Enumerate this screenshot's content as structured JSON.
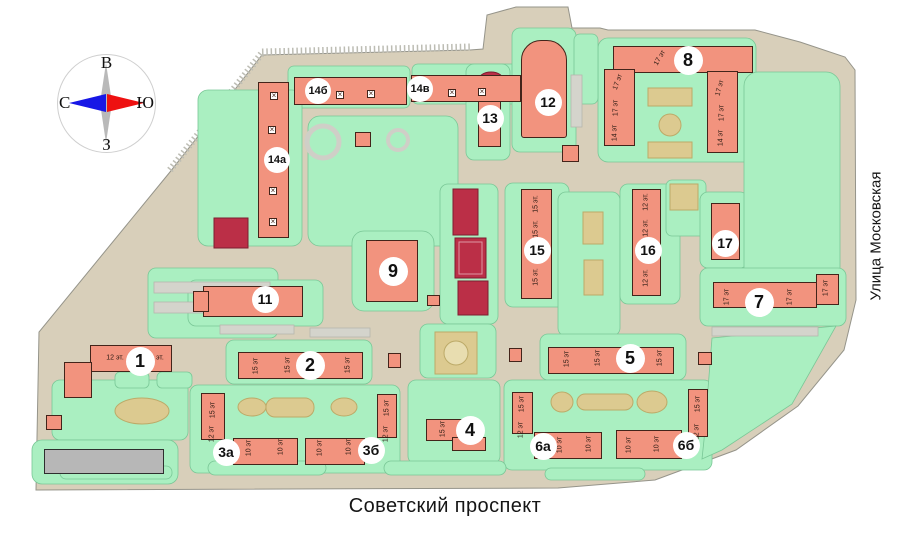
{
  "title": "Генплан жилого комплекса",
  "compass": {
    "top": "В",
    "bottom": "З",
    "left": "С",
    "right": "Ю"
  },
  "streets": {
    "bottom": "Советский проспект",
    "right": "Улица Московская"
  },
  "colors": {
    "building": "#f2937e",
    "building-border": "#43241a",
    "lawn": "#aaefc1",
    "lawn-border": "#79c796",
    "road": "#d8cfba",
    "road-border": "#95948a",
    "court": "#bb2f47",
    "court-border": "#7e1e30",
    "tan": "#dcca90",
    "tan-border": "#bcaa68",
    "gray-building": "#b7b7b7",
    "gray-building-border": "#2e2e2e",
    "parking": "#d4d4cc",
    "parking-border": "#b6b6ad",
    "compass-north": "#1717e6",
    "compass-south": "#ee1111",
    "page-bg": "#ffffff"
  },
  "buildings": [
    {
      "number": "1",
      "cx": 140,
      "cy": 361,
      "parts": [
        {
          "x": 90,
          "y": 345,
          "w": 82,
          "h": 27
        },
        {
          "x": 64,
          "y": 362,
          "w": 28,
          "h": 36
        }
      ],
      "floors": [
        {
          "t": "12 эт.",
          "x": 115,
          "y": 358,
          "r": 0
        },
        {
          "t": "12 эт.",
          "x": 155,
          "y": 358,
          "r": 0
        }
      ]
    },
    {
      "number": "2",
      "cx": 310,
      "cy": 365,
      "parts": [
        {
          "x": 238,
          "y": 352,
          "w": 125,
          "h": 27
        }
      ],
      "floors": [
        {
          "t": "15 эт",
          "x": 256,
          "y": 366
        },
        {
          "t": "15 эт",
          "x": 288,
          "y": 365
        },
        {
          "t": "15 эт",
          "x": 348,
          "y": 365
        }
      ]
    },
    {
      "number": "3а",
      "cx": 226,
      "cy": 452,
      "parts": [
        {
          "x": 201,
          "y": 393,
          "w": 24,
          "h": 47
        },
        {
          "x": 233,
          "y": 438,
          "w": 65,
          "h": 27
        }
      ],
      "floors": [
        {
          "t": "15 эт",
          "x": 213,
          "y": 410
        },
        {
          "t": "12 эт",
          "x": 212,
          "y": 434
        },
        {
          "t": "10 эт",
          "x": 249,
          "y": 448
        },
        {
          "t": "10 эт",
          "x": 281,
          "y": 447
        }
      ]
    },
    {
      "number": "3б",
      "cx": 371,
      "cy": 450,
      "parts": [
        {
          "x": 305,
          "y": 438,
          "w": 60,
          "h": 27
        },
        {
          "x": 377,
          "y": 394,
          "w": 20,
          "h": 44
        }
      ],
      "floors": [
        {
          "t": "10 эт",
          "x": 320,
          "y": 448
        },
        {
          "t": "10 эт",
          "x": 349,
          "y": 447
        },
        {
          "t": "15 эт",
          "x": 387,
          "y": 408
        },
        {
          "t": "12 эт",
          "x": 386,
          "y": 434
        }
      ]
    },
    {
      "number": "4",
      "cx": 470,
      "cy": 430,
      "parts": [
        {
          "x": 426,
          "y": 419,
          "w": 50,
          "h": 22
        },
        {
          "x": 452,
          "y": 437,
          "w": 34,
          "h": 14
        }
      ],
      "floors": [
        {
          "t": "15 эт",
          "x": 443,
          "y": 429
        }
      ]
    },
    {
      "number": "5",
      "cx": 630,
      "cy": 358,
      "parts": [
        {
          "x": 548,
          "y": 347,
          "w": 126,
          "h": 27
        }
      ],
      "floors": [
        {
          "t": "15 эт",
          "x": 567,
          "y": 359
        },
        {
          "t": "15 эт",
          "x": 598,
          "y": 358
        },
        {
          "t": "15 эт",
          "x": 660,
          "y": 358
        }
      ]
    },
    {
      "number": "6а",
      "cx": 543,
      "cy": 446,
      "parts": [
        {
          "x": 512,
          "y": 392,
          "w": 21,
          "h": 42
        },
        {
          "x": 534,
          "y": 432,
          "w": 68,
          "h": 27
        }
      ],
      "floors": [
        {
          "t": "15 эт",
          "x": 522,
          "y": 404
        },
        {
          "t": "12 эт",
          "x": 521,
          "y": 430
        },
        {
          "t": "10 эт",
          "x": 560,
          "y": 445
        },
        {
          "t": "10 эт",
          "x": 589,
          "y": 444
        }
      ]
    },
    {
      "number": "6б",
      "cx": 686,
      "cy": 445,
      "parts": [
        {
          "x": 616,
          "y": 430,
          "w": 66,
          "h": 29
        },
        {
          "x": 688,
          "y": 389,
          "w": 20,
          "h": 48
        }
      ],
      "floors": [
        {
          "t": "10 эт",
          "x": 629,
          "y": 445
        },
        {
          "t": "10 эт",
          "x": 657,
          "y": 444
        },
        {
          "t": "15 эт",
          "x": 698,
          "y": 404
        },
        {
          "t": "12 эт",
          "x": 697,
          "y": 432
        }
      ]
    },
    {
      "number": "7",
      "cx": 759,
      "cy": 302,
      "parts": [
        {
          "x": 713,
          "y": 282,
          "w": 104,
          "h": 26
        },
        {
          "x": 816,
          "y": 274,
          "w": 23,
          "h": 31
        }
      ],
      "floors": [
        {
          "t": "17 эт",
          "x": 727,
          "y": 297
        },
        {
          "t": "17 эт",
          "x": 790,
          "y": 297
        },
        {
          "t": "17 эт",
          "x": 826,
          "y": 288
        }
      ]
    },
    {
      "number": "8",
      "cx": 688,
      "cy": 60,
      "parts": [
        {
          "x": 613,
          "y": 46,
          "w": 140,
          "h": 27
        },
        {
          "x": 604,
          "y": 69,
          "w": 31,
          "h": 77
        },
        {
          "x": 707,
          "y": 71,
          "w": 31,
          "h": 82
        }
      ],
      "floors": [
        {
          "t": "17 эт",
          "x": 660,
          "y": 58,
          "r": -60
        },
        {
          "t": "17 эт",
          "x": 618,
          "y": 82,
          "r": -70
        },
        {
          "t": "17 эт",
          "x": 616,
          "y": 108
        },
        {
          "t": "14 эт",
          "x": 615,
          "y": 133
        },
        {
          "t": "17 эт",
          "x": 720,
          "y": 88,
          "r": -75
        },
        {
          "t": "17 эт",
          "x": 722,
          "y": 113
        },
        {
          "t": "14 эт",
          "x": 721,
          "y": 138
        }
      ]
    },
    {
      "number": "9",
      "cx": 393,
      "cy": 271,
      "parts": [
        {
          "x": 366,
          "y": 240,
          "w": 52,
          "h": 62
        }
      ]
    },
    {
      "number": "11",
      "cx": 265,
      "cy": 299,
      "parts": [
        {
          "x": 203,
          "y": 286,
          "w": 100,
          "h": 31
        },
        {
          "x": 193,
          "y": 291,
          "w": 16,
          "h": 21
        }
      ]
    },
    {
      "number": "12",
      "cx": 548,
      "cy": 102,
      "parts": [
        {
          "x": 521,
          "y": 40,
          "w": 46,
          "h": 98,
          "rad": "20px 20px 3px 3px"
        }
      ]
    },
    {
      "number": "13",
      "cx": 490,
      "cy": 118,
      "parts": [
        {
          "x": 478,
          "y": 97,
          "w": 23,
          "h": 50
        }
      ]
    },
    {
      "number": "14а",
      "cx": 277,
      "cy": 160,
      "parts": [
        {
          "x": 258,
          "y": 82,
          "w": 31,
          "h": 156
        }
      ],
      "marks": [
        {
          "x": 274,
          "y": 96
        },
        {
          "x": 272,
          "y": 130
        },
        {
          "x": 273,
          "y": 191
        },
        {
          "x": 273,
          "y": 222
        }
      ]
    },
    {
      "number": "14б",
      "cx": 318,
      "cy": 91,
      "parts": [
        {
          "x": 294,
          "y": 77,
          "w": 113,
          "h": 28
        }
      ],
      "marks": [
        {
          "x": 340,
          "y": 95
        },
        {
          "x": 371,
          "y": 94
        }
      ]
    },
    {
      "number": "14в",
      "cx": 420,
      "cy": 89,
      "parts": [
        {
          "x": 411,
          "y": 75,
          "w": 110,
          "h": 27
        }
      ],
      "marks": [
        {
          "x": 452,
          "y": 93
        },
        {
          "x": 482,
          "y": 92
        }
      ]
    },
    {
      "number": "15",
      "cx": 537,
      "cy": 250,
      "parts": [
        {
          "x": 521,
          "y": 189,
          "w": 31,
          "h": 110
        }
      ],
      "floors": [
        {
          "t": "15 эт.",
          "x": 536,
          "y": 204
        },
        {
          "t": "15 эт.",
          "x": 536,
          "y": 229
        },
        {
          "t": "15 эт.",
          "x": 536,
          "y": 277
        }
      ]
    },
    {
      "number": "16",
      "cx": 648,
      "cy": 250,
      "parts": [
        {
          "x": 632,
          "y": 189,
          "w": 29,
          "h": 107
        }
      ],
      "floors": [
        {
          "t": "12 эт.",
          "x": 646,
          "y": 202
        },
        {
          "t": "12 эт.",
          "x": 646,
          "y": 228
        },
        {
          "t": "12 эт.",
          "x": 646,
          "y": 278
        }
      ]
    },
    {
      "number": "17",
      "cx": 725,
      "cy": 243,
      "parts": [
        {
          "x": 711,
          "y": 203,
          "w": 29,
          "h": 57
        }
      ]
    },
    {
      "number": null,
      "name": "existing-building",
      "fill": "gray",
      "parts": [
        {
          "x": 44,
          "y": 449,
          "w": 120,
          "h": 25
        }
      ]
    },
    {
      "number": null,
      "name": "service-building",
      "parts": [
        {
          "x": 355,
          "y": 132,
          "w": 16,
          "h": 15
        },
        {
          "x": 427,
          "y": 295,
          "w": 13,
          "h": 11
        },
        {
          "x": 562,
          "y": 145,
          "w": 17,
          "h": 17
        },
        {
          "x": 698,
          "y": 352,
          "w": 14,
          "h": 13
        },
        {
          "x": 388,
          "y": 353,
          "w": 13,
          "h": 15
        },
        {
          "x": 509,
          "y": 348,
          "w": 13,
          "h": 14
        },
        {
          "x": 46,
          "y": 415,
          "w": 16,
          "h": 15
        }
      ]
    }
  ]
}
